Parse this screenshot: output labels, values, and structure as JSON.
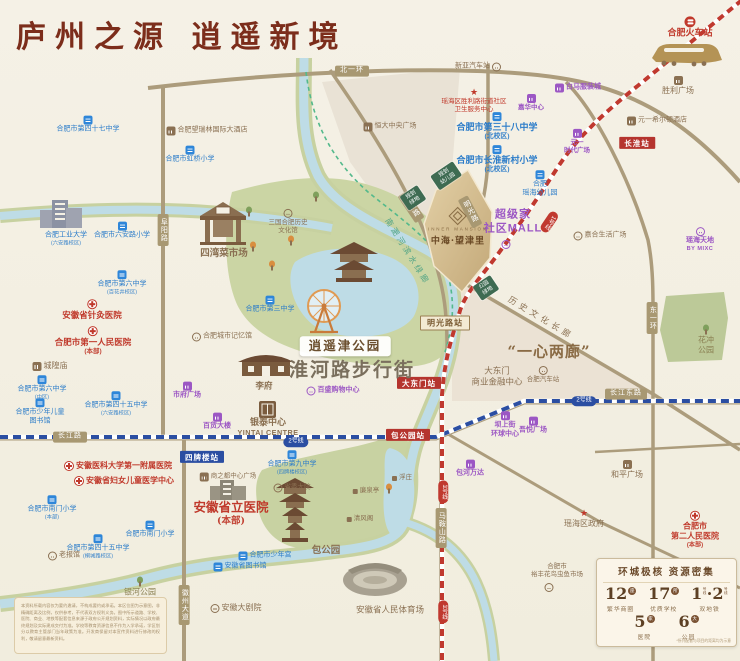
{
  "header": {
    "title": "庐州之源  逍遥新境"
  },
  "project": {
    "en": "INNER MANSION",
    "cn": "中海·望津里"
  },
  "colors": {
    "paper": "#F5F1E6",
    "title_red": "#7C2D1B",
    "road_tan": "#AC9C7C",
    "school_blue": "#2B7CC9",
    "hospital_red": "#C0392B",
    "mall_purple": "#9C57C4",
    "brown": "#8A7052",
    "metro_line1_red": "#C0392F",
    "metro_line2_blue": "#2B4EA2",
    "park_green": "#CBD5A4",
    "river_blue": "#BEDCE6",
    "plan_green": "#3E6B52",
    "project_gold": "#D3BC90"
  },
  "stats": {
    "title": "环城极核  资源密集",
    "items": [
      {
        "num": "12",
        "unit": "座",
        "label": "繁华商圈"
      },
      {
        "num": "17",
        "unit": "所",
        "label": "优质学校"
      },
      {
        "num": "1·2",
        "unit": "号线",
        "label": "双地铁",
        "dual": true
      },
      {
        "num": "5",
        "unit": "家",
        "label": "医院"
      },
      {
        "num": "6",
        "unit": "大",
        "label": "公园"
      }
    ],
    "note": "*所列配套与项目的距离均为示意"
  },
  "disclaimer": {
    "text": "本资料所载内容仅为要约邀请，不构成要约或承诺。本区位图为示意图，非精确距离及比例，仅供参考，不代表双方权利义务。图中所示道路、学校、医院、商业、地铁等配套信息来源于政府公开规划资料，实际情况以政府最终规划及实际建成交付为准。学校等教育资源信息不作为入学承诺，学区划分以教育主管部门当年政策为准。开发商保留对本宣传资料进行修改的权利，敬请留意最新资料。"
  },
  "map": {
    "labels": [
      {
        "ls": [
          "北一环"
        ],
        "c": "rbad",
        "x": 352,
        "y": 71,
        "n": "road-beiyihuan"
      },
      {
        "ls": [
          "长江路"
        ],
        "c": "rbad",
        "x": 70,
        "y": 437,
        "n": "road-changjianglu"
      },
      {
        "ls": [
          "长江东路"
        ],
        "c": "rbad",
        "x": 626,
        "y": 394,
        "n": "road-changjiangdonglu"
      },
      {
        "ls": [
          "阜阳路"
        ],
        "c": "vbad",
        "x": 163,
        "y": 230,
        "n": "road-fuyanglu"
      },
      {
        "ls": [
          "东一环"
        ],
        "c": "vbad",
        "x": 652,
        "y": 318,
        "n": "road-dongyihuan"
      },
      {
        "ls": [
          "徽州大道"
        ],
        "c": "vbad",
        "x": 184,
        "y": 605,
        "n": "road-huizhoudadao"
      },
      {
        "ls": [
          "马鞍山路"
        ],
        "c": "vbad",
        "x": 441,
        "y": 528,
        "n": "road-maanshanlu"
      },
      {
        "ls": [
          "滁州路"
        ],
        "c": "vbad",
        "x": 411,
        "y": 207,
        "rot": -34,
        "n": "road-chuzhoulu"
      },
      {
        "ls": [
          "明光路"
        ],
        "c": "vbad",
        "x": 470,
        "y": 212,
        "rot": -28,
        "n": "road-mingguanglu"
      },
      {
        "ls": [
          "长淮站"
        ],
        "c": "st-red",
        "x": 637,
        "y": 143,
        "n": "station-changhuai"
      },
      {
        "ls": [
          "大东门站"
        ],
        "c": "st-red",
        "x": 419,
        "y": 383,
        "n": "station-dadongmen"
      },
      {
        "ls": [
          "包公园站"
        ],
        "c": "st-red",
        "x": 408,
        "y": 435,
        "n": "station-baogongyuan"
      },
      {
        "ls": [
          "四牌楼站"
        ],
        "c": "st-blue",
        "x": 202,
        "y": 457,
        "n": "station-sipailou"
      },
      {
        "ls": [
          "明光路站"
        ],
        "c": "st-cream",
        "x": 445,
        "y": 323,
        "n": "station-mingguanglu"
      },
      {
        "ls": [
          "2号线"
        ],
        "c": "pill2",
        "x": 296,
        "y": 442,
        "n": "metro-line2-badge"
      },
      {
        "ls": [
          "2号线"
        ],
        "c": "pill2",
        "x": 584,
        "y": 401,
        "n": "metro-line2-badge"
      },
      {
        "ls": [
          "1号线"
        ],
        "c": "pill1",
        "x": 443,
        "y": 492,
        "n": "metro-line1-badge"
      },
      {
        "ls": [
          "1号线"
        ],
        "c": "pill1",
        "x": 443,
        "y": 612,
        "n": "metro-line1-badge"
      },
      {
        "ls": [
          "1号线"
        ],
        "c": "pill1",
        "x": 549,
        "y": 222,
        "rot": 34,
        "n": "metro-line1-badge"
      },
      {
        "ls": [
          "规划",
          "幼儿园"
        ],
        "c": "gbox",
        "x": 446,
        "y": 176,
        "rot": -34,
        "n": "planned-kindergarten"
      },
      {
        "ls": [
          "规划",
          "绿地"
        ],
        "c": "gbox",
        "x": 413,
        "y": 198,
        "rot": -34,
        "n": "planned-green"
      },
      {
        "ls": [
          "公园",
          "绿地"
        ],
        "c": "gbox",
        "x": 486,
        "y": 288,
        "rot": -34,
        "n": "park-green"
      },
      {
        "ls": [
          "合肥市第四十七中学"
        ],
        "c": "sch",
        "ic": "school",
        "x": 88,
        "y": 125
      },
      {
        "ls": [
          "合肥市虹桥小学"
        ],
        "c": "sch",
        "ic": "school",
        "x": 190,
        "y": 155
      },
      {
        "ls": [
          "合肥市六安路小学"
        ],
        "c": "sch",
        "ic": "school",
        "x": 122,
        "y": 231
      },
      {
        "ls": [
          "合肥工业大学",
          "(六安路校区)"
        ],
        "c": "sch",
        "x": 66,
        "y": 239
      },
      {
        "ls": [
          "合肥市第六中学",
          "(百花井校区)"
        ],
        "c": "sch",
        "ic": "school",
        "x": 122,
        "y": 283
      },
      {
        "ls": [
          "合肥市第三中学"
        ],
        "c": "sch",
        "ic": "school",
        "x": 270,
        "y": 305
      },
      {
        "ls": [
          "合肥市第六中学",
          "(中区)"
        ],
        "c": "sch",
        "ic": "school",
        "x": 42,
        "y": 388
      },
      {
        "ls": [
          "合肥市第四十五中学",
          "(六安路校区)"
        ],
        "c": "sch",
        "ic": "school",
        "x": 116,
        "y": 404
      },
      {
        "ls": [
          "合肥市少年儿童",
          "图书馆"
        ],
        "c": "sch",
        "ic": "school",
        "x": 40,
        "y": 412
      },
      {
        "ls": [
          "合肥市第三十八中学",
          "(北校区)"
        ],
        "c": "sch bb",
        "ic": "school",
        "x": 497,
        "y": 127,
        "fs": 9
      },
      {
        "ls": [
          "合肥市长淮新村小学",
          "(北校区)"
        ],
        "c": "sch bb",
        "ic": "school",
        "x": 497,
        "y": 160,
        "fs": 9
      },
      {
        "ls": [
          "合肥",
          "瑶海幼儿园"
        ],
        "c": "sch",
        "ic": "school",
        "x": 540,
        "y": 184
      },
      {
        "ls": [
          "合肥市第九中学",
          "(四牌楼校区)"
        ],
        "c": "sch",
        "ic": "school",
        "x": 292,
        "y": 463
      },
      {
        "ls": [
          "合肥市南门小学",
          "(本部)"
        ],
        "c": "sch",
        "ic": "school",
        "x": 52,
        "y": 508
      },
      {
        "ls": [
          "合肥市南门小学"
        ],
        "c": "sch",
        "ic": "school",
        "x": 150,
        "y": 530
      },
      {
        "ls": [
          "合肥市第四十五中学",
          "(桐城路校区)"
        ],
        "c": "sch",
        "ic": "school",
        "x": 98,
        "y": 547
      },
      {
        "ls": [
          "合肥市少年宫"
        ],
        "c": "sch",
        "ic": "school",
        "ip": "left",
        "x": 265,
        "y": 556
      },
      {
        "ls": [
          "安徽省图书馆"
        ],
        "c": "sch",
        "ic": "school",
        "ip": "left",
        "x": 240,
        "y": 567
      },
      {
        "ls": [
          "瑶海区胜利路街道社区",
          "卫生服务中心"
        ],
        "c": "hos",
        "ic": "star",
        "x": 474,
        "y": 101,
        "fs": 6.5
      },
      {
        "ls": [
          "安徽省针灸医院"
        ],
        "c": "hos bb",
        "ic": "cross",
        "x": 92,
        "y": 310,
        "fs": 8.5
      },
      {
        "ls": [
          "合肥市第一人民医院",
          "(本部)"
        ],
        "c": "hos bb",
        "ic": "cross",
        "x": 93,
        "y": 341,
        "fs": 8.5
      },
      {
        "ls": [
          "安徽医科大学第一附属医院"
        ],
        "c": "hos bb",
        "ic": "cross",
        "ip": "left",
        "x": 118,
        "y": 466,
        "fs": 8
      },
      {
        "ls": [
          "安徽省妇女儿童医学中心"
        ],
        "c": "hos bb",
        "ic": "cross",
        "ip": "left",
        "x": 124,
        "y": 481,
        "fs": 8
      },
      {
        "ls": [
          "安徽省立医院",
          "(本部)"
        ],
        "c": "hos big2",
        "x": 231,
        "y": 513
      },
      {
        "ls": [
          "合肥市",
          "第二人民医院",
          "(本部)"
        ],
        "c": "hos bb",
        "ic": "cross",
        "x": 695,
        "y": 530,
        "fs": 8
      },
      {
        "ls": [
          "白马服装城"
        ],
        "c": "mal",
        "ic": "mallp",
        "ip": "left",
        "x": 578,
        "y": 88
      },
      {
        "ls": [
          "嘉华中心"
        ],
        "c": "mal",
        "ic": "mallp",
        "x": 531,
        "y": 103,
        "fs": 6.5
      },
      {
        "ls": [
          "元一",
          "时代广场"
        ],
        "c": "mal",
        "ic": "mallp",
        "x": 577,
        "y": 142,
        "fs": 6.5
      },
      {
        "ls": [
          "市府广场"
        ],
        "c": "mal",
        "ic": "mallp",
        "x": 187,
        "y": 391
      },
      {
        "ls": [
          "百货大楼"
        ],
        "c": "mal",
        "ic": "mallp",
        "x": 217,
        "y": 422
      },
      {
        "ls": [
          "百盛购物中心"
        ],
        "c": "mal",
        "ic": "circlep",
        "ip": "left",
        "x": 333,
        "y": 391
      },
      {
        "ls": [
          "坝上街",
          "环球中心"
        ],
        "c": "mal",
        "ic": "mallp",
        "x": 505,
        "y": 425
      },
      {
        "ls": [
          "吾悦广场"
        ],
        "c": "mal",
        "ic": "mallp",
        "x": 533,
        "y": 426
      },
      {
        "ls": [
          "包河万达"
        ],
        "c": "mal",
        "ic": "mallp",
        "x": 470,
        "y": 469
      },
      {
        "ls": [
          "瑶海天地",
          "BY MIXC"
        ],
        "c": "mal",
        "ic": "circlep",
        "x": 700,
        "y": 240
      },
      {
        "ls": [
          "超级家",
          "社区MALL"
        ],
        "c": "mal big2",
        "x": 513,
        "y": 222
      },
      {
        "ls": [
          "合肥望瑞林国际大酒店"
        ],
        "c": "brn",
        "ic": "mallb",
        "ip": "left",
        "x": 207,
        "y": 131
      },
      {
        "ls": [
          "元一希尔顿酒店"
        ],
        "c": "brn",
        "ic": "mallb",
        "ip": "left",
        "x": 657,
        "y": 121
      },
      {
        "ls": [
          "胜利广场"
        ],
        "c": "brn",
        "ic": "mallb",
        "x": 678,
        "y": 86,
        "fs": 8
      },
      {
        "ls": [
          "新亚汽车站"
        ],
        "c": "brn",
        "ic": "circle",
        "ip": "right",
        "x": 478,
        "y": 67
      },
      {
        "ls": [
          "恒大中央广场"
        ],
        "c": "brn",
        "ic": "mallb",
        "ip": "left",
        "x": 390,
        "y": 127
      },
      {
        "ls": [
          "四湾菜市场"
        ],
        "c": "brn bb",
        "x": 224,
        "y": 254,
        "fs": 9.5
      },
      {
        "ls": [
          "三国合肥历史",
          "文化馆"
        ],
        "c": "brn",
        "ic": "circle",
        "x": 288,
        "y": 222,
        "fs": 6.5
      },
      {
        "ls": [
          "合肥城市记忆馆"
        ],
        "c": "brn",
        "ic": "circle",
        "ip": "left",
        "x": 222,
        "y": 337
      },
      {
        "ls": [
          "城隍庙"
        ],
        "c": "brn",
        "ic": "mallb",
        "ip": "left",
        "x": 50,
        "y": 366,
        "fs": 8
      },
      {
        "ls": [
          "李府"
        ],
        "c": "brn bb",
        "x": 264,
        "y": 386,
        "fs": 8.5
      },
      {
        "ls": [
          "银泰中心",
          "YINTAI CENTRE"
        ],
        "c": "brn bb",
        "x": 268,
        "y": 427,
        "fs": 9
      },
      {
        "ls": [
          "老报馆"
        ],
        "c": "brn",
        "ic": "circle",
        "ip": "left",
        "x": 64,
        "y": 556
      },
      {
        "ls": [
          "省委大院"
        ],
        "c": "brn",
        "ic": "circle",
        "ip": "left",
        "x": 292,
        "y": 488,
        "fs": 6.5
      },
      {
        "ls": [
          "浮庄"
        ],
        "c": "brn",
        "ic": "dot",
        "ip": "left",
        "x": 402,
        "y": 478,
        "fs": 6.5
      },
      {
        "ls": [
          "廉泉亭"
        ],
        "c": "brn",
        "ic": "dot",
        "ip": "left",
        "x": 366,
        "y": 491,
        "fs": 6.5
      },
      {
        "ls": [
          "清风阁"
        ],
        "c": "brn",
        "ic": "dot",
        "ip": "left",
        "x": 360,
        "y": 519,
        "fs": 6.5
      },
      {
        "ls": [
          "包公园"
        ],
        "c": "brn bb",
        "x": 326,
        "y": 551,
        "fs": 9.5
      },
      {
        "ls": [
          "合肥汽车站"
        ],
        "c": "brn",
        "ic": "circle",
        "x": 543,
        "y": 375,
        "fs": 6.5
      },
      {
        "ls": [
          "大东门",
          "商业金融中心"
        ],
        "c": "brn",
        "x": 497,
        "y": 376,
        "fs": 8.5
      },
      {
        "ls": [
          "和平广场"
        ],
        "c": "brn",
        "ic": "mallb",
        "x": 627,
        "y": 470,
        "fs": 8
      },
      {
        "ls": [
          "瑶海区政府"
        ],
        "c": "brn",
        "ic": "star",
        "x": 584,
        "y": 519,
        "fs": 8
      },
      {
        "ls": [
          "合肥市",
          "裕丰花鸟虫鱼市场"
        ],
        "c": "brn",
        "x": 557,
        "y": 571,
        "fs": 6.5
      },
      {
        "ls": [
          "安徽大剧院"
        ],
        "c": "brn",
        "ic": "circle",
        "ip": "left",
        "x": 236,
        "y": 608,
        "fs": 8
      },
      {
        "ls": [
          "安徽省人民体育场"
        ],
        "c": "brn",
        "x": 390,
        "y": 610,
        "fs": 8.5
      },
      {
        "ls": [
          "嘉合生活广场"
        ],
        "c": "brn",
        "ic": "circle",
        "ip": "left",
        "x": 600,
        "y": 236,
        "fs": 7
      },
      {
        "ls": [
          "商之都中心广场"
        ],
        "c": "brn",
        "ic": "mallb",
        "ip": "left",
        "x": 228,
        "y": 477,
        "fs": 6.5
      },
      {
        "ls": [
          "银河公园"
        ],
        "c": "pk",
        "ic": "tree",
        "x": 140,
        "y": 587,
        "fs": 8
      },
      {
        "ls": [
          "花冲",
          "公园"
        ],
        "c": "pk",
        "ic": "tree",
        "x": 706,
        "y": 340,
        "fs": 8
      },
      {
        "ls": [
          "南淝河滨水绿廊"
        ],
        "c": "cor-green",
        "x": 407,
        "y": 252,
        "rot": 58
      },
      {
        "ls": [
          "历史文化长廊"
        ],
        "c": "cor-brown",
        "x": 541,
        "y": 318,
        "rot": 31
      },
      {
        "ls": [
          "逍遥津公园"
        ],
        "c": "parkbadge",
        "x": 345,
        "y": 346,
        "n": "xiaoyaojin-park-badge"
      },
      {
        "ls": [
          "淮河路步行街"
        ],
        "c": "street",
        "x": 352,
        "y": 371,
        "n": "huaihe-road-pedestrian-street"
      },
      {
        "ls": [
          "“一心两廊”"
        ],
        "c": "quote",
        "x": 549,
        "y": 352,
        "n": "one-heart-two-corridors"
      },
      {
        "ls": [
          "合肥火车站"
        ],
        "c": "rail-label",
        "ic": "rail",
        "x": 690,
        "y": 28,
        "n": "hefei-railway-station"
      },
      {
        "ls": [],
        "ic": "circlep",
        "x": 506,
        "y": 245
      },
      {
        "ls": [],
        "ic": "circle",
        "x": 549,
        "y": 588
      },
      {
        "ls": [],
        "ic": "treegold",
        "x": 253,
        "y": 247
      },
      {
        "ls": [],
        "ic": "treegold",
        "x": 272,
        "y": 266
      },
      {
        "ls": [],
        "ic": "treegold",
        "x": 291,
        "y": 241
      },
      {
        "ls": [],
        "ic": "treegold",
        "x": 389,
        "y": 489
      },
      {
        "ls": [],
        "ic": "tree",
        "x": 249,
        "y": 212
      },
      {
        "ls": [],
        "ic": "tree",
        "x": 316,
        "y": 197
      }
    ]
  }
}
